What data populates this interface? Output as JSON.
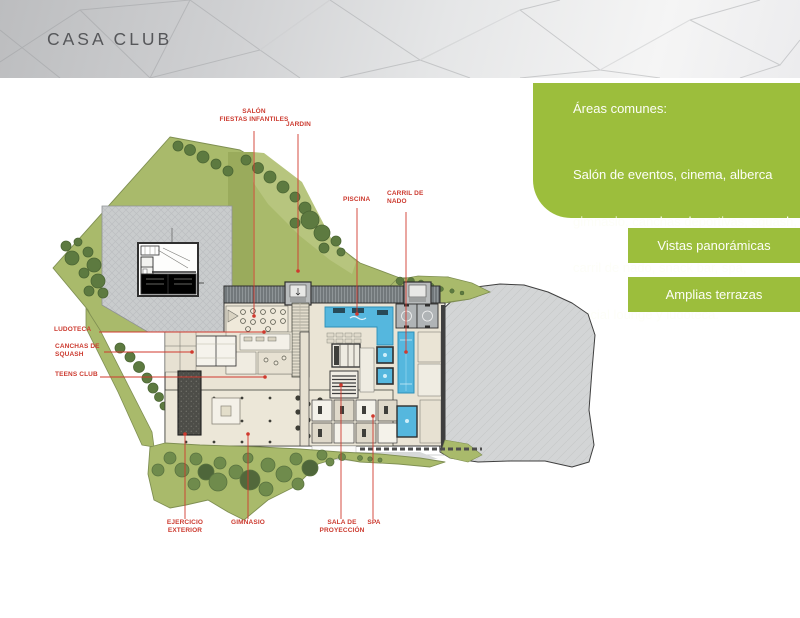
{
  "header": {
    "title": "CASA CLUB"
  },
  "panel": {
    "heading": "Áreas comunes:",
    "line1": "Salón de eventos, cinema, alberca",
    "line2": "gimnasio, canchas deportivas, squash,",
    "line3": "carril de nado, snack bar, spa,",
    "line4": " social lounge y ludoteca."
  },
  "badges": [
    {
      "label": "Vistas panorámicas"
    },
    {
      "label": "Amplias terrazas"
    }
  ],
  "plan": {
    "labels": [
      {
        "id": "salon",
        "line1": "SALÓN",
        "line2": "FIESTAS INFANTILES"
      },
      {
        "id": "jardin",
        "line1": "JARDIN"
      },
      {
        "id": "piscina",
        "line1": "PISCINA"
      },
      {
        "id": "carril",
        "line1": "CARRIL DE",
        "line2": "NADO"
      },
      {
        "id": "ludoteca",
        "line1": "LUDOTECA"
      },
      {
        "id": "canchas",
        "line1": "CANCHAS DE",
        "line2": "SQUASH"
      },
      {
        "id": "teens",
        "line1": "TEENS CLUB"
      },
      {
        "id": "ejercicio",
        "line1": "EJERCICIO",
        "line2": "EXTERIOR"
      },
      {
        "id": "gimnasio",
        "line1": "GIMNASIO"
      },
      {
        "id": "sala",
        "line1": "SALA DE",
        "line2": "PROYECCIÓN"
      },
      {
        "id": "spa",
        "line1": "SPA"
      }
    ]
  },
  "colors": {
    "accent_green": "#9cbe3c",
    "label_red": "#cc3a2f",
    "site_green": "#a9ba6b",
    "pool_blue": "#55b7de",
    "plaza_gray": "#c9cccd"
  }
}
